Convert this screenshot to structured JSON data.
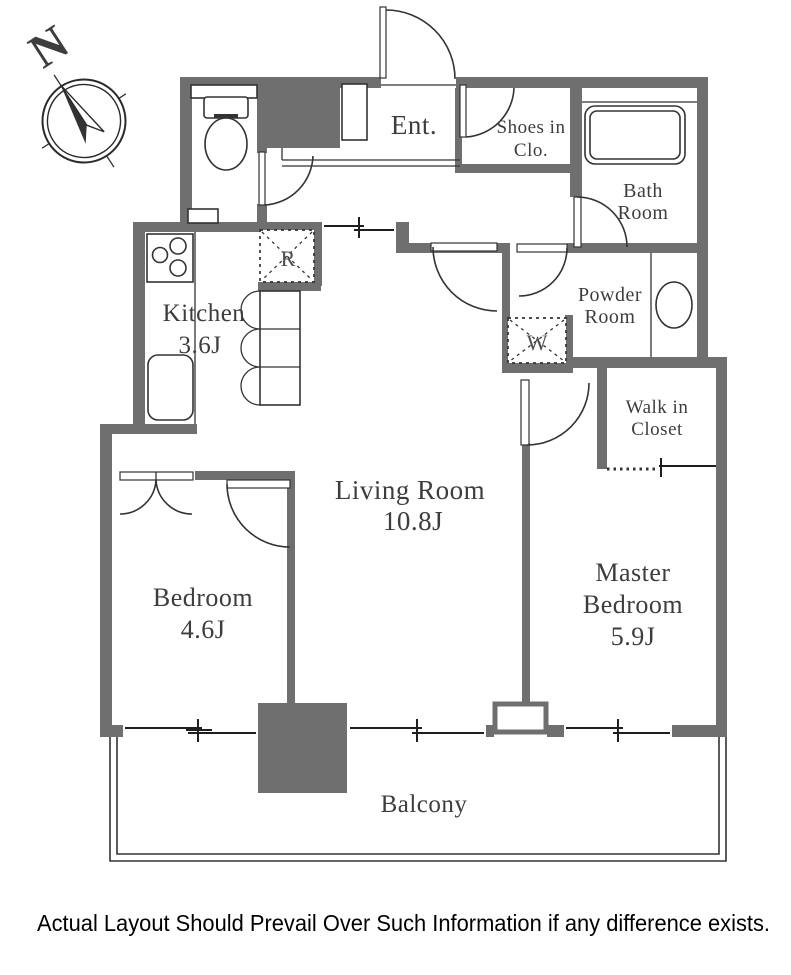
{
  "title": "Apartment floor plan",
  "compass": {
    "letter": "N"
  },
  "rooms": {
    "entrance": {
      "name": "Ent."
    },
    "shoes_closet": {
      "line1": "Shoes in",
      "line2": "Clo."
    },
    "bath": {
      "line1": "Bath",
      "line2": "Room"
    },
    "powder": {
      "line1": "Powder",
      "line2": "Room"
    },
    "walk_in_closet": {
      "line1": "Walk in",
      "line2": "Closet"
    },
    "kitchen": {
      "name": "Kitchen",
      "size": "3.6J"
    },
    "living": {
      "name": "Living Room",
      "size": "10.8J"
    },
    "bedroom": {
      "name": "Bedroom",
      "size": "4.6J"
    },
    "master": {
      "line1": "Master",
      "line2": "Bedroom",
      "size": "5.9J"
    },
    "balcony": {
      "name": "Balcony"
    }
  },
  "markers": {
    "refrigerator": "R",
    "washer": "W"
  },
  "footer": {
    "disclaimer": "Actual Layout Should Prevail Over Such Information if any difference exists."
  },
  "colors": {
    "wall": "#6f6f6f",
    "line": "#333333",
    "text": "#3d3d3d",
    "marker": "#4e4e4e",
    "window": "#1f1f1f"
  }
}
